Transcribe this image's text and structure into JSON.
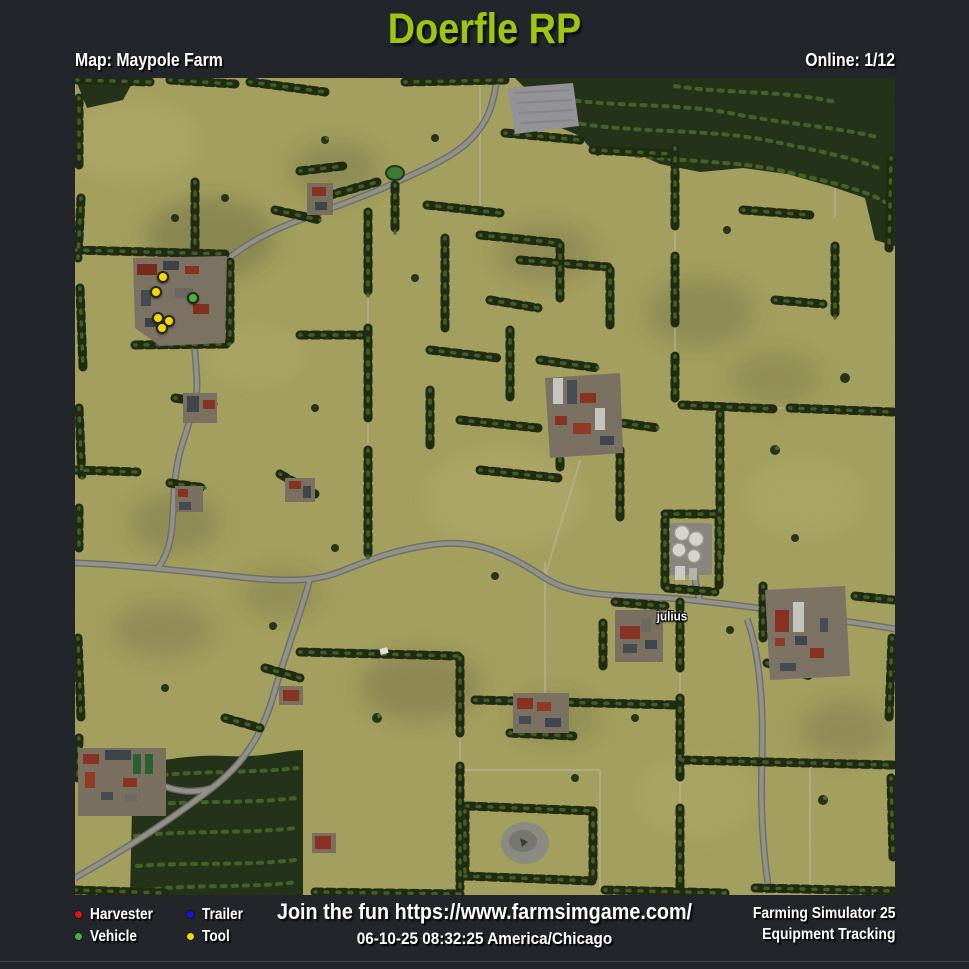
{
  "title": "Doerfle RP",
  "header": {
    "map_label": "Map: Maypole Farm",
    "online_label": "Online: 1/12"
  },
  "map": {
    "player_labels": [
      {
        "text": "julius",
        "x_pct": 72.8,
        "y_pct": 65.9
      }
    ],
    "markers": [
      {
        "type": "tool",
        "x_pct": 10.7,
        "y_pct": 24.4
      },
      {
        "type": "tool",
        "x_pct": 9.9,
        "y_pct": 26.2
      },
      {
        "type": "vehicle",
        "x_pct": 14.4,
        "y_pct": 26.9
      },
      {
        "type": "tool",
        "x_pct": 10.1,
        "y_pct": 29.4
      },
      {
        "type": "tool",
        "x_pct": 11.5,
        "y_pct": 29.7
      },
      {
        "type": "tool",
        "x_pct": 10.6,
        "y_pct": 30.6
      }
    ]
  },
  "legend": {
    "items": [
      {
        "label": "Harvester",
        "color": "#e31219"
      },
      {
        "label": "Vehicle",
        "color": "#45b33b"
      },
      {
        "label": "Trailer",
        "color": "#1616e0"
      },
      {
        "label": "Tool",
        "color": "#f8d800"
      }
    ]
  },
  "footer": {
    "promo": "Join the fun https://www.farmsimgame.com/",
    "timestamp": "06-10-25 08:32:25 America/Chicago",
    "brand_line1": "Farming Simulator 25",
    "brand_line2": "Equipment Tracking"
  },
  "colors": {
    "page_bg": "#22262b",
    "title": "#9fc412",
    "text": "#ffffff"
  }
}
